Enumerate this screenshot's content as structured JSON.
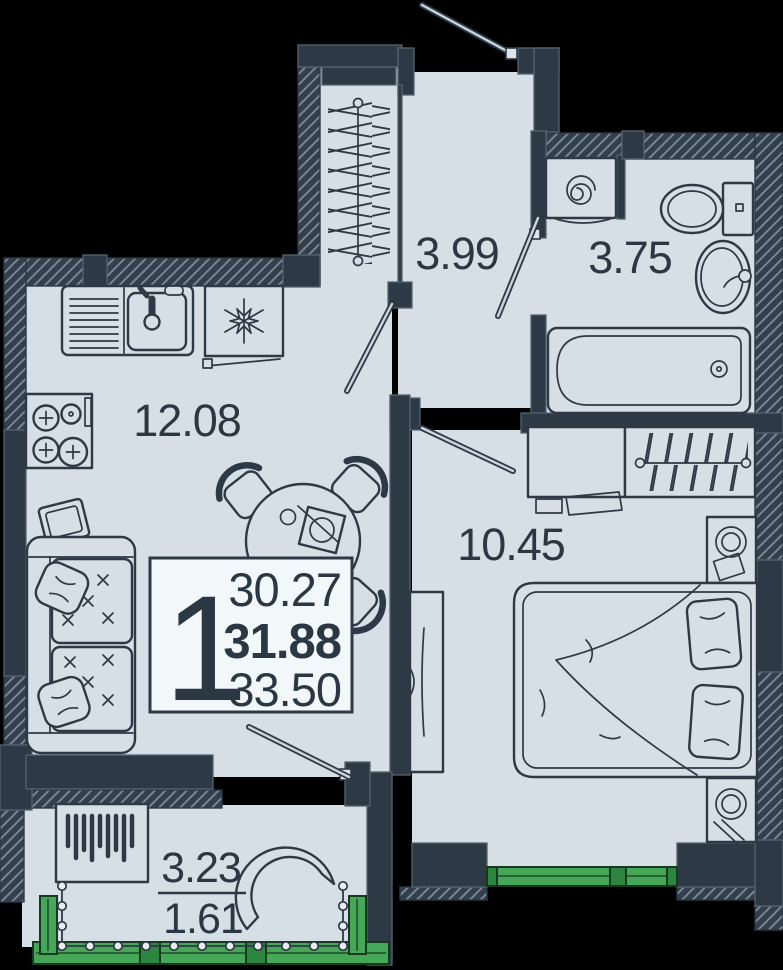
{
  "floorplan": {
    "unit_info": {
      "rooms_count": "1",
      "living_area": "30.27",
      "total_area": "31.88",
      "area_with_summer": "33.50"
    },
    "rooms": {
      "kitchen_living": {
        "area": "12.08"
      },
      "hallway": {
        "area": "3.99"
      },
      "bathroom": {
        "area": "3.75"
      },
      "bedroom": {
        "area": "10.45"
      },
      "balcony": {
        "area_full": "3.23",
        "area_reduced": "1.61"
      }
    },
    "colors": {
      "background": "#000000",
      "wall": "#2e3946",
      "floor": "#d6dfe6",
      "accent_green": "#46a758",
      "accent_green_dark": "#2e8540",
      "info_box_bg": "#f2f7f9",
      "line": "#2e3946"
    },
    "icons": {
      "fridge": "snowflake-icon",
      "washer": "spiral-icon",
      "stove": "burner-plus-icon"
    }
  }
}
